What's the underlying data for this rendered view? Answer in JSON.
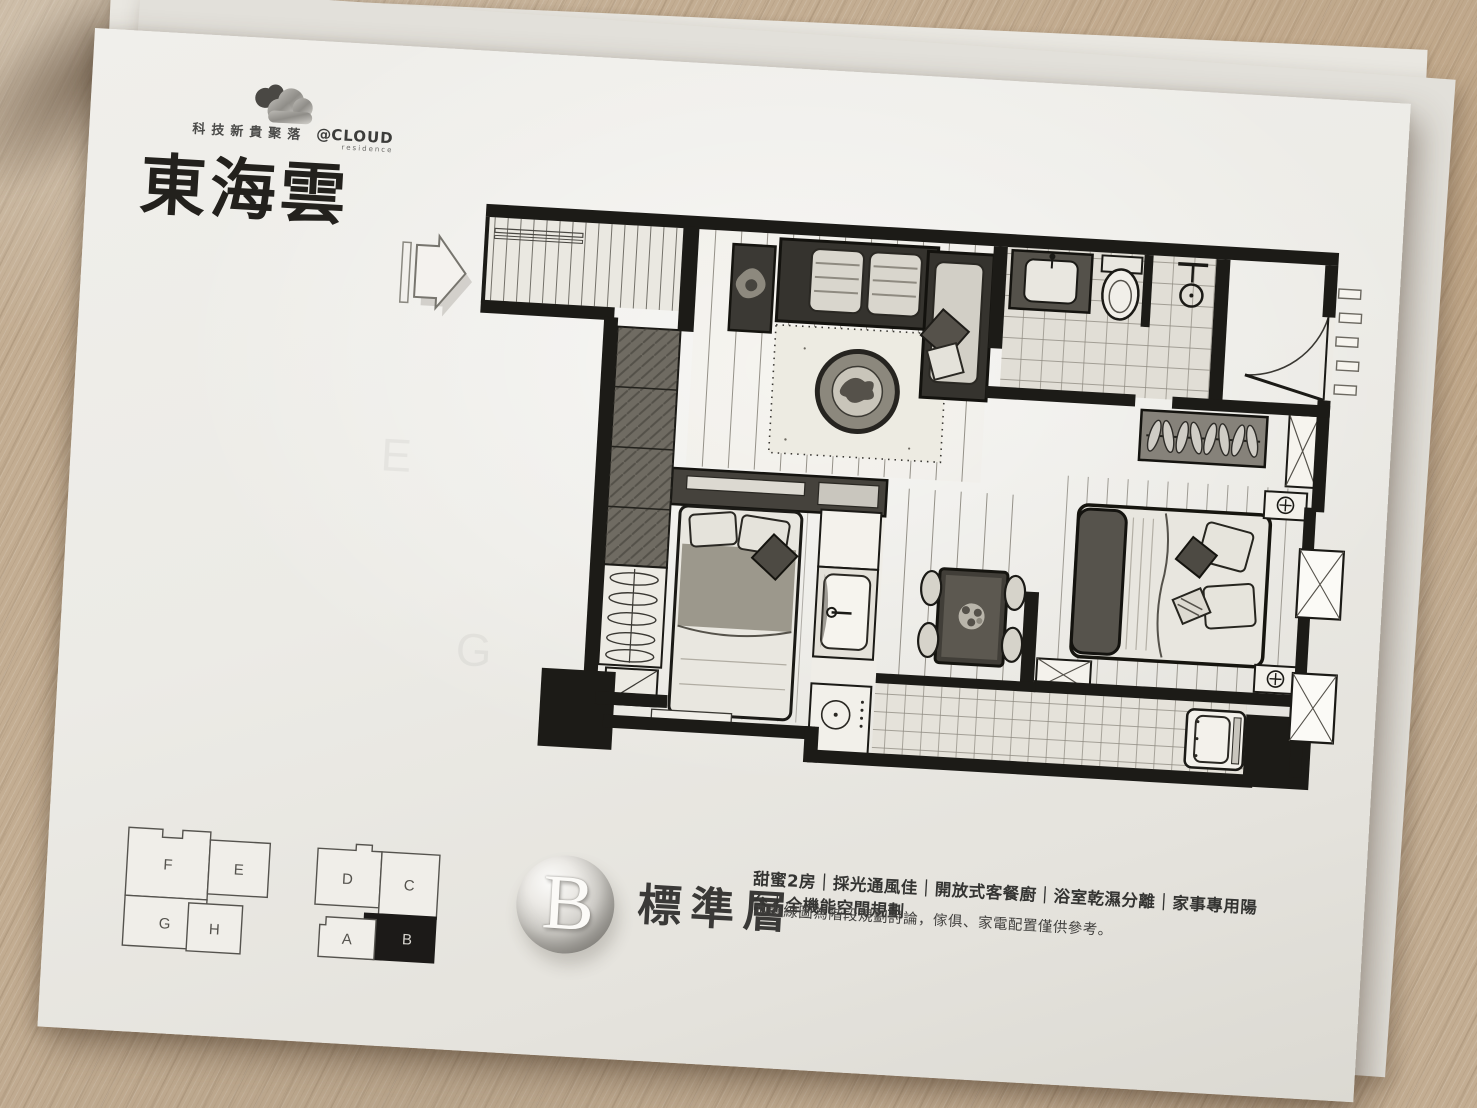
{
  "brand": {
    "tagline": "科技新貴聚落",
    "mark": "@",
    "name": "CLOUD",
    "sub": "residence",
    "title": "東海雲"
  },
  "badge": {
    "letter": "B",
    "floor_label": "標準層"
  },
  "features_line": "甜蜜2房｜採光通風佳｜開放式客餐廚｜浴室乾濕分離｜家事專用陽台｜全機能空間規劃",
  "disclaimer": "本墨線圖為階段規劃討論，傢俱、家電配置僅供參考。",
  "key_plan": {
    "left_block": [
      "F",
      "E",
      "G",
      "H"
    ],
    "right_block": [
      "D",
      "C",
      "A",
      "B"
    ],
    "highlighted_unit": "B"
  },
  "showthrough": {
    "letters": [
      "E",
      "G"
    ]
  },
  "icons": {
    "logo": "cloud-icon",
    "plan_direction": "direction-arrow-icon"
  },
  "colors": {
    "ink": "#1c1a18",
    "paper": "#edebe6",
    "wood": "#c3ad92",
    "highlighted_unit_fill": "#1c1a18"
  }
}
